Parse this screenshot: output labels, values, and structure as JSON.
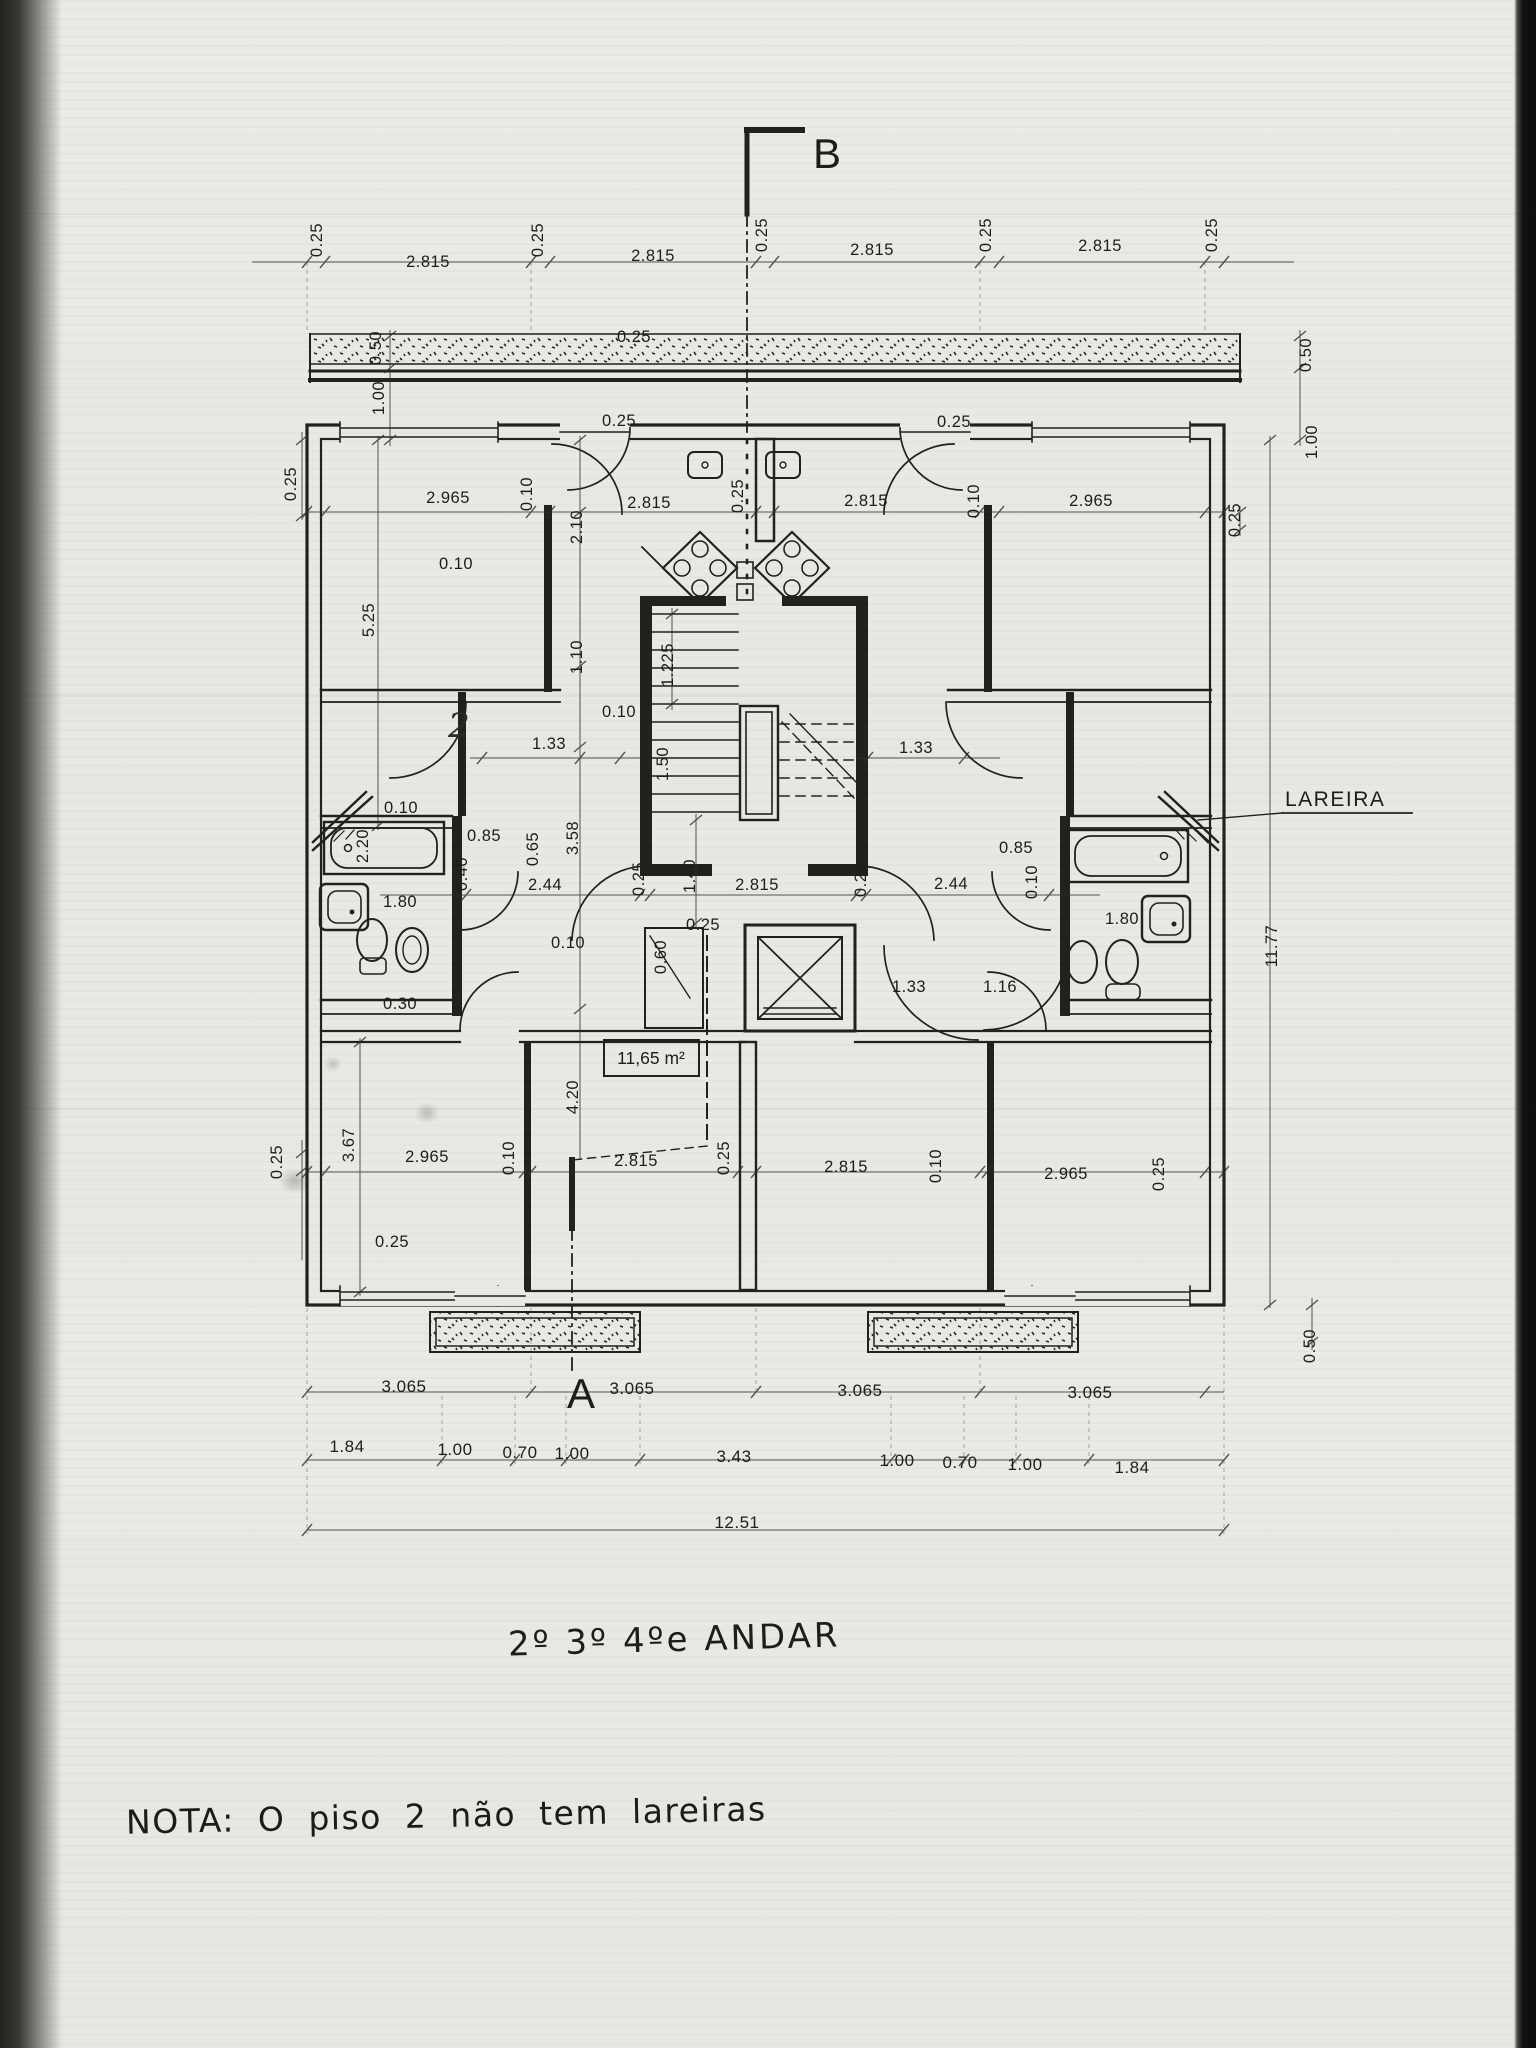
{
  "page": {
    "background": "#e9e8e4",
    "ink": "#21211f",
    "scan_left_edge": "#232220",
    "scan_right_edge": "#0d0d0d"
  },
  "title": {
    "text": "2º 3º 4ºe ANDAR"
  },
  "note": {
    "text": "NOTA: O piso 2 não tem lareiras"
  },
  "plan": {
    "fireplace_label": "LAREIRA",
    "area_label": "11,65 m²",
    "section_mark_top": "B",
    "section_mark_bottom": "A",
    "total_width_m": "12.51",
    "total_depth_m": "11.77"
  },
  "labels": [
    {
      "t": "0.25",
      "x": 322,
      "y": 240,
      "r": -90
    },
    {
      "t": "2.815",
      "x": 428,
      "y": 267
    },
    {
      "t": "0.25",
      "x": 543,
      "y": 240,
      "r": -90
    },
    {
      "t": "2.815",
      "x": 653,
      "y": 261
    },
    {
      "t": "0.25",
      "x": 767,
      "y": 235,
      "r": -90
    },
    {
      "t": "2.815",
      "x": 872,
      "y": 255
    },
    {
      "t": "0.25",
      "x": 991,
      "y": 235,
      "r": -90
    },
    {
      "t": "2.815",
      "x": 1100,
      "y": 251
    },
    {
      "t": "0.25",
      "x": 1217,
      "y": 235,
      "r": -90
    },
    {
      "t": "0.50",
      "x": 381,
      "y": 348,
      "r": -90
    },
    {
      "t": "1.00",
      "x": 384,
      "y": 398,
      "r": -90
    },
    {
      "t": "0.25",
      "x": 634,
      "y": 342
    },
    {
      "t": "0.50",
      "x": 1311,
      "y": 355,
      "r": -90
    },
    {
      "t": "1.00",
      "x": 1317,
      "y": 442,
      "r": -90
    },
    {
      "t": "0.25",
      "x": 296,
      "y": 484,
      "r": -90
    },
    {
      "t": "2.965",
      "x": 448,
      "y": 503
    },
    {
      "t": "0.10",
      "x": 532,
      "y": 494,
      "r": -90
    },
    {
      "t": "0.25",
      "x": 619,
      "y": 426
    },
    {
      "t": "2.815",
      "x": 649,
      "y": 508
    },
    {
      "t": "0.25",
      "x": 743,
      "y": 496,
      "r": -90
    },
    {
      "t": "2.815",
      "x": 866,
      "y": 506
    },
    {
      "t": "0.10",
      "x": 979,
      "y": 501,
      "r": -90
    },
    {
      "t": "2.965",
      "x": 1091,
      "y": 506
    },
    {
      "t": "0.25",
      "x": 954,
      "y": 427
    },
    {
      "t": "0.25",
      "x": 1240,
      "y": 520,
      "r": -90
    },
    {
      "t": "5.25",
      "x": 374,
      "y": 620,
      "r": -90
    },
    {
      "t": "2.10",
      "x": 582,
      "y": 527,
      "r": -90
    },
    {
      "t": "0.10",
      "x": 456,
      "y": 569
    },
    {
      "t": "1.10",
      "x": 582,
      "y": 657,
      "r": -90
    },
    {
      "t": "1.225",
      "x": 673,
      "y": 665,
      "r": -90
    },
    {
      "t": "0.10",
      "x": 619,
      "y": 717
    },
    {
      "t": "1.33",
      "x": 549,
      "y": 749
    },
    {
      "t": "1.50",
      "x": 668,
      "y": 764,
      "r": -90
    },
    {
      "t": "1.33",
      "x": 916,
      "y": 753
    },
    {
      "t": "2",
      "x": 459,
      "y": 737,
      "cls": "hand",
      "name": "handwritten-mark"
    },
    {
      "t": "3.58",
      "x": 578,
      "y": 838,
      "r": -90
    },
    {
      "t": "0.85",
      "x": 484,
      "y": 841
    },
    {
      "t": "0.65",
      "x": 538,
      "y": 849,
      "r": -90
    },
    {
      "t": "0.40",
      "x": 467,
      "y": 874,
      "r": -90
    },
    {
      "t": "2.44",
      "x": 545,
      "y": 890
    },
    {
      "t": "2.20",
      "x": 368,
      "y": 846,
      "r": -90
    },
    {
      "t": "0.10",
      "x": 401,
      "y": 813
    },
    {
      "t": "1.80",
      "x": 400,
      "y": 907
    },
    {
      "t": "0.30",
      "x": 400,
      "y": 1009
    },
    {
      "t": "0.25",
      "x": 644,
      "y": 879,
      "r": -90
    },
    {
      "t": "1.40",
      "x": 695,
      "y": 876,
      "r": -90
    },
    {
      "t": "2.815",
      "x": 757,
      "y": 890
    },
    {
      "t": "0.25",
      "x": 866,
      "y": 880,
      "r": -90
    },
    {
      "t": "2.44",
      "x": 951,
      "y": 889
    },
    {
      "t": "0.85",
      "x": 1016,
      "y": 853
    },
    {
      "t": "0.10",
      "x": 1037,
      "y": 882,
      "r": -90
    },
    {
      "t": "1.80",
      "x": 1122,
      "y": 924
    },
    {
      "t": "0.10",
      "x": 568,
      "y": 948
    },
    {
      "t": "0.25",
      "x": 703,
      "y": 930
    },
    {
      "t": "0.60",
      "x": 666,
      "y": 957,
      "r": -90
    },
    {
      "t": "1.33",
      "x": 909,
      "y": 992
    },
    {
      "t": "1.16",
      "x": 1000,
      "y": 992
    },
    {
      "t": "11,65 m²",
      "x": 651,
      "y": 1064,
      "cls": "area",
      "name": "room-area-label"
    },
    {
      "t": "4.20",
      "x": 578,
      "y": 1097,
      "r": -90
    },
    {
      "t": "0.25",
      "x": 282,
      "y": 1162,
      "r": -90
    },
    {
      "t": "3.67",
      "x": 354,
      "y": 1145,
      "r": -90
    },
    {
      "t": "2.965",
      "x": 427,
      "y": 1162
    },
    {
      "t": "0.10",
      "x": 514,
      "y": 1158,
      "r": -90
    },
    {
      "t": "2.815",
      "x": 636,
      "y": 1166
    },
    {
      "t": "0.25",
      "x": 729,
      "y": 1158,
      "r": -90
    },
    {
      "t": "2.815",
      "x": 846,
      "y": 1172
    },
    {
      "t": "0.10",
      "x": 941,
      "y": 1166,
      "r": -90
    },
    {
      "t": "2.965",
      "x": 1066,
      "y": 1179
    },
    {
      "t": "0.25",
      "x": 1164,
      "y": 1174,
      "r": -90
    },
    {
      "t": "0.25",
      "x": 392,
      "y": 1247
    },
    {
      "t": "11.77",
      "x": 1277,
      "y": 946,
      "r": -90
    },
    {
      "t": "0.50",
      "x": 1315,
      "y": 1346,
      "r": -90
    },
    {
      "t": "LAREIRA",
      "x": 1285,
      "y": 806,
      "cls": "callout",
      "anchor": "start",
      "name": "fireplace-label"
    },
    {
      "t": "3.065",
      "x": 404,
      "y": 1392,
      "cls": "chain"
    },
    {
      "t": "3.065",
      "x": 632,
      "y": 1394,
      "cls": "chain"
    },
    {
      "t": "3.065",
      "x": 860,
      "y": 1396,
      "cls": "chain"
    },
    {
      "t": "3.065",
      "x": 1090,
      "y": 1398,
      "cls": "chain"
    },
    {
      "t": "1.84",
      "x": 347,
      "y": 1452,
      "cls": "chain"
    },
    {
      "t": "1.00",
      "x": 455,
      "y": 1455,
      "cls": "chain"
    },
    {
      "t": "0.70",
      "x": 520,
      "y": 1458,
      "cls": "chain"
    },
    {
      "t": "1.00",
      "x": 572,
      "y": 1459,
      "cls": "chain"
    },
    {
      "t": "3.43",
      "x": 734,
      "y": 1462,
      "cls": "chain"
    },
    {
      "t": "1.00",
      "x": 897,
      "y": 1466,
      "cls": "chain"
    },
    {
      "t": "0.70",
      "x": 960,
      "y": 1468,
      "cls": "chain"
    },
    {
      "t": "1.00",
      "x": 1025,
      "y": 1470,
      "cls": "chain"
    },
    {
      "t": "1.84",
      "x": 1132,
      "y": 1473,
      "cls": "chain"
    },
    {
      "t": "12.51",
      "x": 737,
      "y": 1528,
      "cls": "chain"
    },
    {
      "t": "B",
      "x": 827,
      "y": 168,
      "cls": "big",
      "name": "section-mark-b"
    },
    {
      "t": "A",
      "x": 581,
      "y": 1408,
      "cls": "big",
      "name": "section-mark-a"
    }
  ]
}
